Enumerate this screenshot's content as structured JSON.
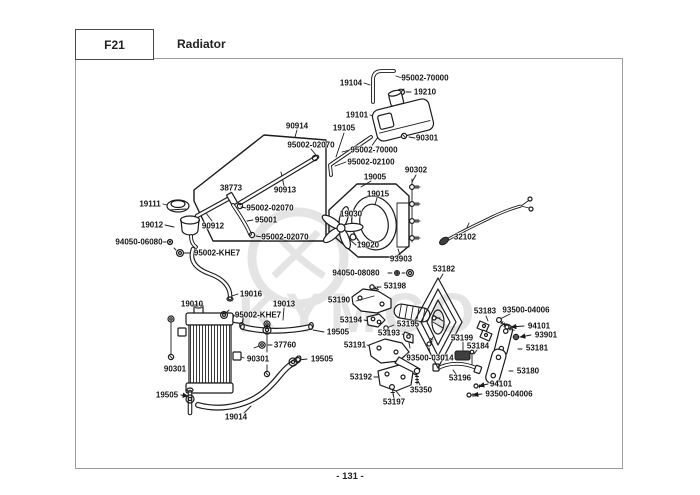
{
  "header": {
    "code": "F21",
    "title": "Radiator"
  },
  "footer": {
    "page_number": "- 131 -"
  },
  "watermark": {
    "text": "KYMCO"
  },
  "colors": {
    "line": "#1b1b1b",
    "frame": "#9c9c9c",
    "watermark": "#e4e4e4",
    "dark_part": "#3f3f3f"
  },
  "diagram": {
    "labels": [
      {
        "text": "19104",
        "x": 351,
        "y": 83
      },
      {
        "text": "95002-70000",
        "x": 425,
        "y": 78
      },
      {
        "text": "19210",
        "x": 425,
        "y": 92
      },
      {
        "text": "19101",
        "x": 357,
        "y": 115
      },
      {
        "text": "90301",
        "x": 427,
        "y": 138
      },
      {
        "text": "19105",
        "x": 344,
        "y": 128
      },
      {
        "text": "95002-70000",
        "x": 374,
        "y": 150
      },
      {
        "text": "95002-02100",
        "x": 371,
        "y": 162
      },
      {
        "text": "90914",
        "x": 297,
        "y": 126
      },
      {
        "text": "95002-02070",
        "x": 311,
        "y": 145
      },
      {
        "text": "38773",
        "x": 231,
        "y": 188
      },
      {
        "text": "90913",
        "x": 285,
        "y": 190
      },
      {
        "text": "95002-02070",
        "x": 270,
        "y": 208
      },
      {
        "text": "95001",
        "x": 266,
        "y": 220
      },
      {
        "text": "90912",
        "x": 213,
        "y": 226
      },
      {
        "text": "95002-02070",
        "x": 285,
        "y": 237
      },
      {
        "text": "19005",
        "x": 375,
        "y": 177
      },
      {
        "text": "19015",
        "x": 378,
        "y": 194
      },
      {
        "text": "19030",
        "x": 351,
        "y": 214
      },
      {
        "text": "19020",
        "x": 368,
        "y": 245
      },
      {
        "text": "90302",
        "x": 416,
        "y": 170
      },
      {
        "text": "32102",
        "x": 465,
        "y": 237
      },
      {
        "text": "93903",
        "x": 401,
        "y": 259
      },
      {
        "text": "19111",
        "x": 150,
        "y": 204
      },
      {
        "text": "19012",
        "x": 152,
        "y": 225
      },
      {
        "text": "94050-06080",
        "x": 139,
        "y": 242
      },
      {
        "text": "95002-KHE7",
        "x": 217,
        "y": 253
      },
      {
        "text": "19016",
        "x": 251,
        "y": 294
      },
      {
        "text": "19010",
        "x": 192,
        "y": 304
      },
      {
        "text": "19013",
        "x": 284,
        "y": 304
      },
      {
        "text": "95002-KHE7",
        "x": 258,
        "y": 315
      },
      {
        "text": "94050-08080",
        "x": 356,
        "y": 273
      },
      {
        "text": "53198",
        "x": 395,
        "y": 286
      },
      {
        "text": "53190",
        "x": 339,
        "y": 300
      },
      {
        "text": "53194",
        "x": 351,
        "y": 320
      },
      {
        "text": "53195",
        "x": 408,
        "y": 324
      },
      {
        "text": "19505",
        "x": 338,
        "y": 332
      },
      {
        "text": "53193",
        "x": 389,
        "y": 333
      },
      {
        "text": "53191",
        "x": 355,
        "y": 345
      },
      {
        "text": "37760",
        "x": 285,
        "y": 345
      },
      {
        "text": "90301",
        "x": 175,
        "y": 369
      },
      {
        "text": "90301",
        "x": 258,
        "y": 359
      },
      {
        "text": "19505",
        "x": 322,
        "y": 359
      },
      {
        "text": "19505",
        "x": 167,
        "y": 395
      },
      {
        "text": "19014",
        "x": 236,
        "y": 417
      },
      {
        "text": "93500-03014",
        "x": 430,
        "y": 358
      },
      {
        "text": "53192",
        "x": 361,
        "y": 377
      },
      {
        "text": "35350",
        "x": 421,
        "y": 390
      },
      {
        "text": "53197",
        "x": 394,
        "y": 402
      },
      {
        "text": "53196",
        "x": 460,
        "y": 378
      },
      {
        "text": "53182",
        "x": 444,
        "y": 269
      },
      {
        "text": "53199",
        "x": 462,
        "y": 338
      },
      {
        "text": "53184",
        "x": 478,
        "y": 346
      },
      {
        "text": "53183",
        "x": 485,
        "y": 311
      },
      {
        "text": "93500-04006",
        "x": 526,
        "y": 310
      },
      {
        "text": "94101",
        "x": 539,
        "y": 326
      },
      {
        "text": "93901",
        "x": 546,
        "y": 335
      },
      {
        "text": "53181",
        "x": 537,
        "y": 348
      },
      {
        "text": "53180",
        "x": 528,
        "y": 371
      },
      {
        "text": "94101",
        "x": 501,
        "y": 384
      },
      {
        "text": "93500-04006",
        "x": 509,
        "y": 394
      }
    ]
  }
}
